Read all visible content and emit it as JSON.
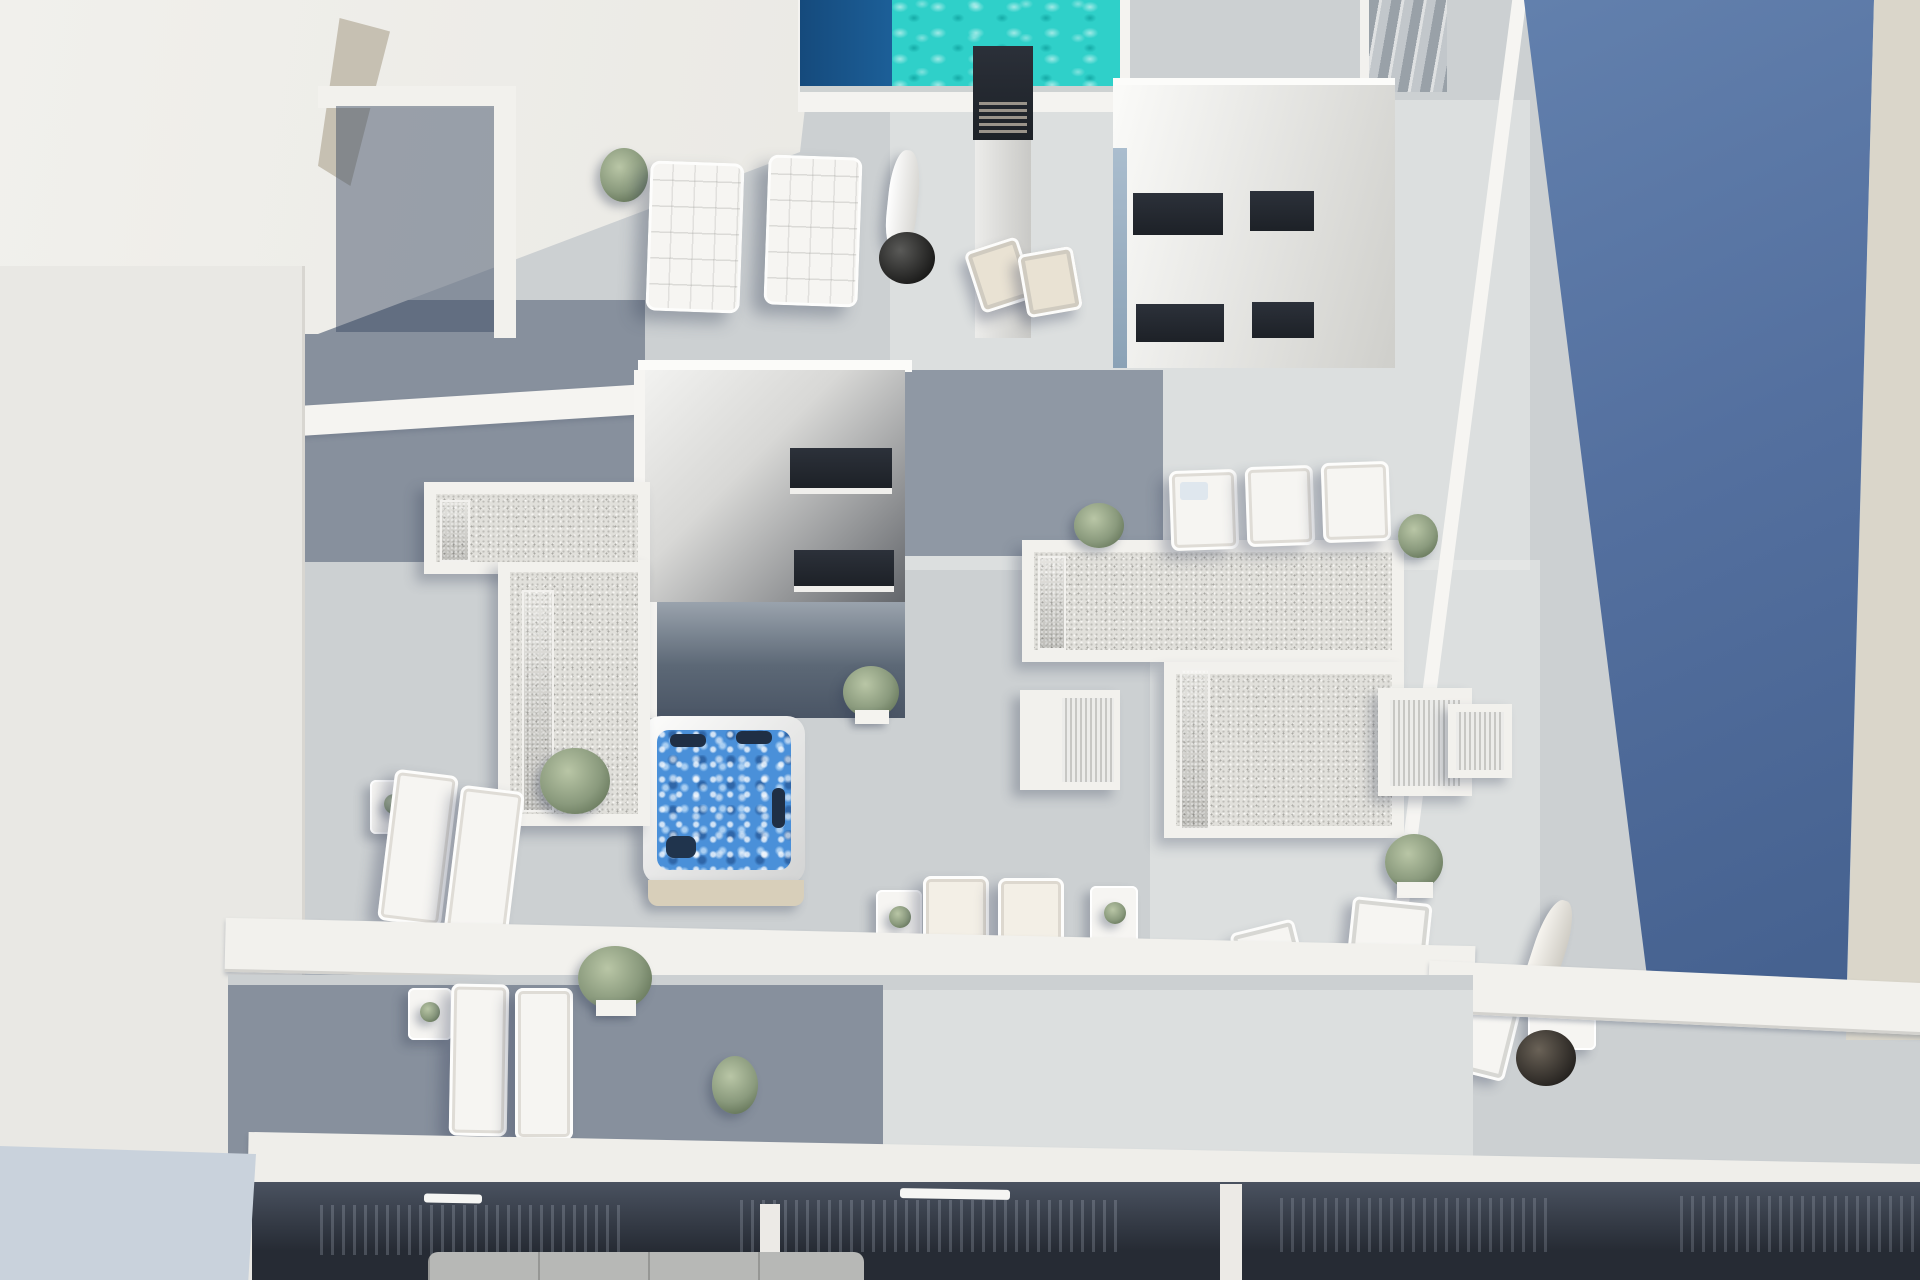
{
  "meta": {
    "type": "3d-architectural-render",
    "view": "aerial-top-down",
    "subject": "Rooftop solarium terrace of a modern white apartment building with swimming pool, hot tub and sun decks, flanked by neighbouring buildings"
  },
  "palette": {
    "deck": "#ccd0d2",
    "wall": "#f2f1ed",
    "wall-dim": "#e9e8e4",
    "pool": "#2fd0c9",
    "pool-deep": "#1c5f98",
    "tub": "#4a90d9",
    "glass": "#3f5c8c",
    "glass-hi": "#6787b5",
    "gravel": "#e1e0db",
    "blue-bldg-1": "#6280ad",
    "blue-bldg-2": "#44608e",
    "beige": "#dad6ca",
    "dark-win": "#1d2127",
    "green": "#8a9a7d",
    "furn": "#f6f5f2",
    "cushion": "#e9e2d3",
    "lower-dark": "#262b34"
  },
  "objects": {
    "neighbor_left": {
      "label": "adjacent white building mass (top left)",
      "color": "#efeeea"
    },
    "boundary_wall_left": {
      "label": "white boundary wall along left edge",
      "color": "#edece8"
    },
    "pool": {
      "label": "rooftop swimming pool with rippled turquoise water and dark deep section",
      "water_color": "#2fd0c9",
      "deep_color": "#1c5f98"
    },
    "stairs": {
      "label": "exterior stair flight at top right",
      "color": "#9aa2a8"
    },
    "neighbor_right": {
      "label": "neighbouring blue high building face",
      "colors": [
        "#6280ad",
        "#44608e"
      ],
      "edge_strip_color": "#dad6ca"
    },
    "chimney": {
      "label": "dark chimney / vent stack with louvre grille",
      "color": "#23272d"
    },
    "bulkhead_upper": {
      "label": "white stair bulkhead with two rows of dark slot windows",
      "window_color": "#1d2127"
    },
    "bulkhead_lower": {
      "label": "stair bulkhead with shaded roof and two dark skylight slots",
      "window_color": "#17191d"
    },
    "hot_tub": {
      "label": "square hot tub with bubbling blue water, four dark headrests and beige access step",
      "water_color": "#4a90d9"
    },
    "gravel_roof_left": {
      "label": "L-shaped gravel roof with two blue glass skylight strips",
      "gravel": "#e1e0db",
      "glass": "#3f5c8c"
    },
    "gravel_roof_right": {
      "label": "T-shaped gravel roof with blue glass skylight strips",
      "gravel": "#e1e0db",
      "glass": "#3f5c8c"
    },
    "louver_cabinets": {
      "label": "two white louvered plant-room cabinets",
      "count": 2
    },
    "padded_loungers": {
      "label": "two white quilted sun loungers beside the pool",
      "count": 2
    },
    "deck_chairs": {
      "label": "two folding deck chairs with beige cushions",
      "count": 2
    },
    "parasol_pool": {
      "label": "closed white parasol with round dark base beside pool",
      "base_color": "#2e2e2e"
    },
    "flat_loungers": {
      "label": "three flat white loungers on upper right deck",
      "count": 3
    },
    "loungers_lower_left": {
      "label": "two white loungers with side table, lower left terrace",
      "count": 2
    },
    "loungers_center": {
      "label": "two cream loungers with white side tables, center terrace",
      "count": 2
    },
    "dining_set": {
      "label": "round white dining table with red centerpiece and four white chairs",
      "chairs": 4,
      "centerpiece_color": "#c0392b"
    },
    "parasol_right": {
      "label": "leaning closed parasol with dark round base and side table, right terrace"
    },
    "ac_unit": {
      "label": "white rooftop AC / utility unit"
    },
    "planters": {
      "label": "potted green shrubs and plants across the terraces",
      "count": 9,
      "color": "#8a9a7d"
    },
    "lower_terrace": {
      "label": "lower floor terrace with two loungers, side table and shrubs"
    },
    "lower_glazing": {
      "label": "lower floor dark glass sliding doors with white handles and railings",
      "color": "#262b34"
    },
    "sofa": {
      "label": "grey sofa partially visible on lowest floor",
      "color": "#b7b8b6"
    },
    "decking": {
      "label": "grey timber plank decking with diagonal sun and shadow areas",
      "color": "#ccd0d2"
    }
  }
}
